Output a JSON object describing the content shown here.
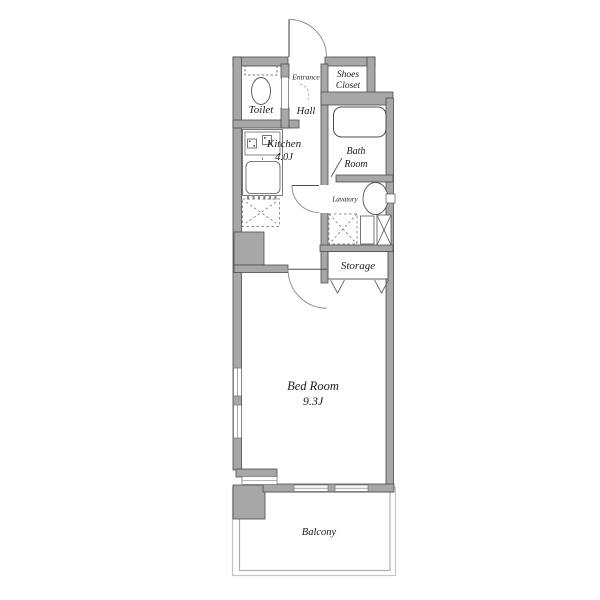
{
  "rooms": {
    "toilet": {
      "label": "Toilet"
    },
    "entrance": {
      "label": "Entrance"
    },
    "hall": {
      "label": "Hall"
    },
    "shoes_closet": {
      "label_line1": "Shoes",
      "label_line2": "Closet"
    },
    "kitchen": {
      "label": "Kitchen",
      "size": "4.0J"
    },
    "bath_room": {
      "label_line1": "Bath",
      "label_line2": "Room"
    },
    "lavatory": {
      "label": "Lavatory"
    },
    "storage": {
      "label": "Storage"
    },
    "bed_room": {
      "label": "Bed Room",
      "size": "9.3J"
    },
    "balcony": {
      "label": "Balcony"
    }
  },
  "fixtures": [
    "toilet-bowl",
    "toilet-tank",
    "kitchen-stove",
    "kitchen-sink",
    "refrigerator-space",
    "bathtub",
    "lavatory-sink",
    "washing-machine-space",
    "pipe-space",
    "storage-folding-door",
    "entrance-door",
    "lavatory-door",
    "bedroom-door",
    "bath-door"
  ],
  "colors": {
    "wall_fill": "#a7a7a7",
    "wall_outline": "#4d4d4d",
    "door_arc": "#8a8a8a",
    "balcony_outline": "#c0c0c0",
    "text": "#1c1c1c",
    "background": "#ffffff"
  }
}
